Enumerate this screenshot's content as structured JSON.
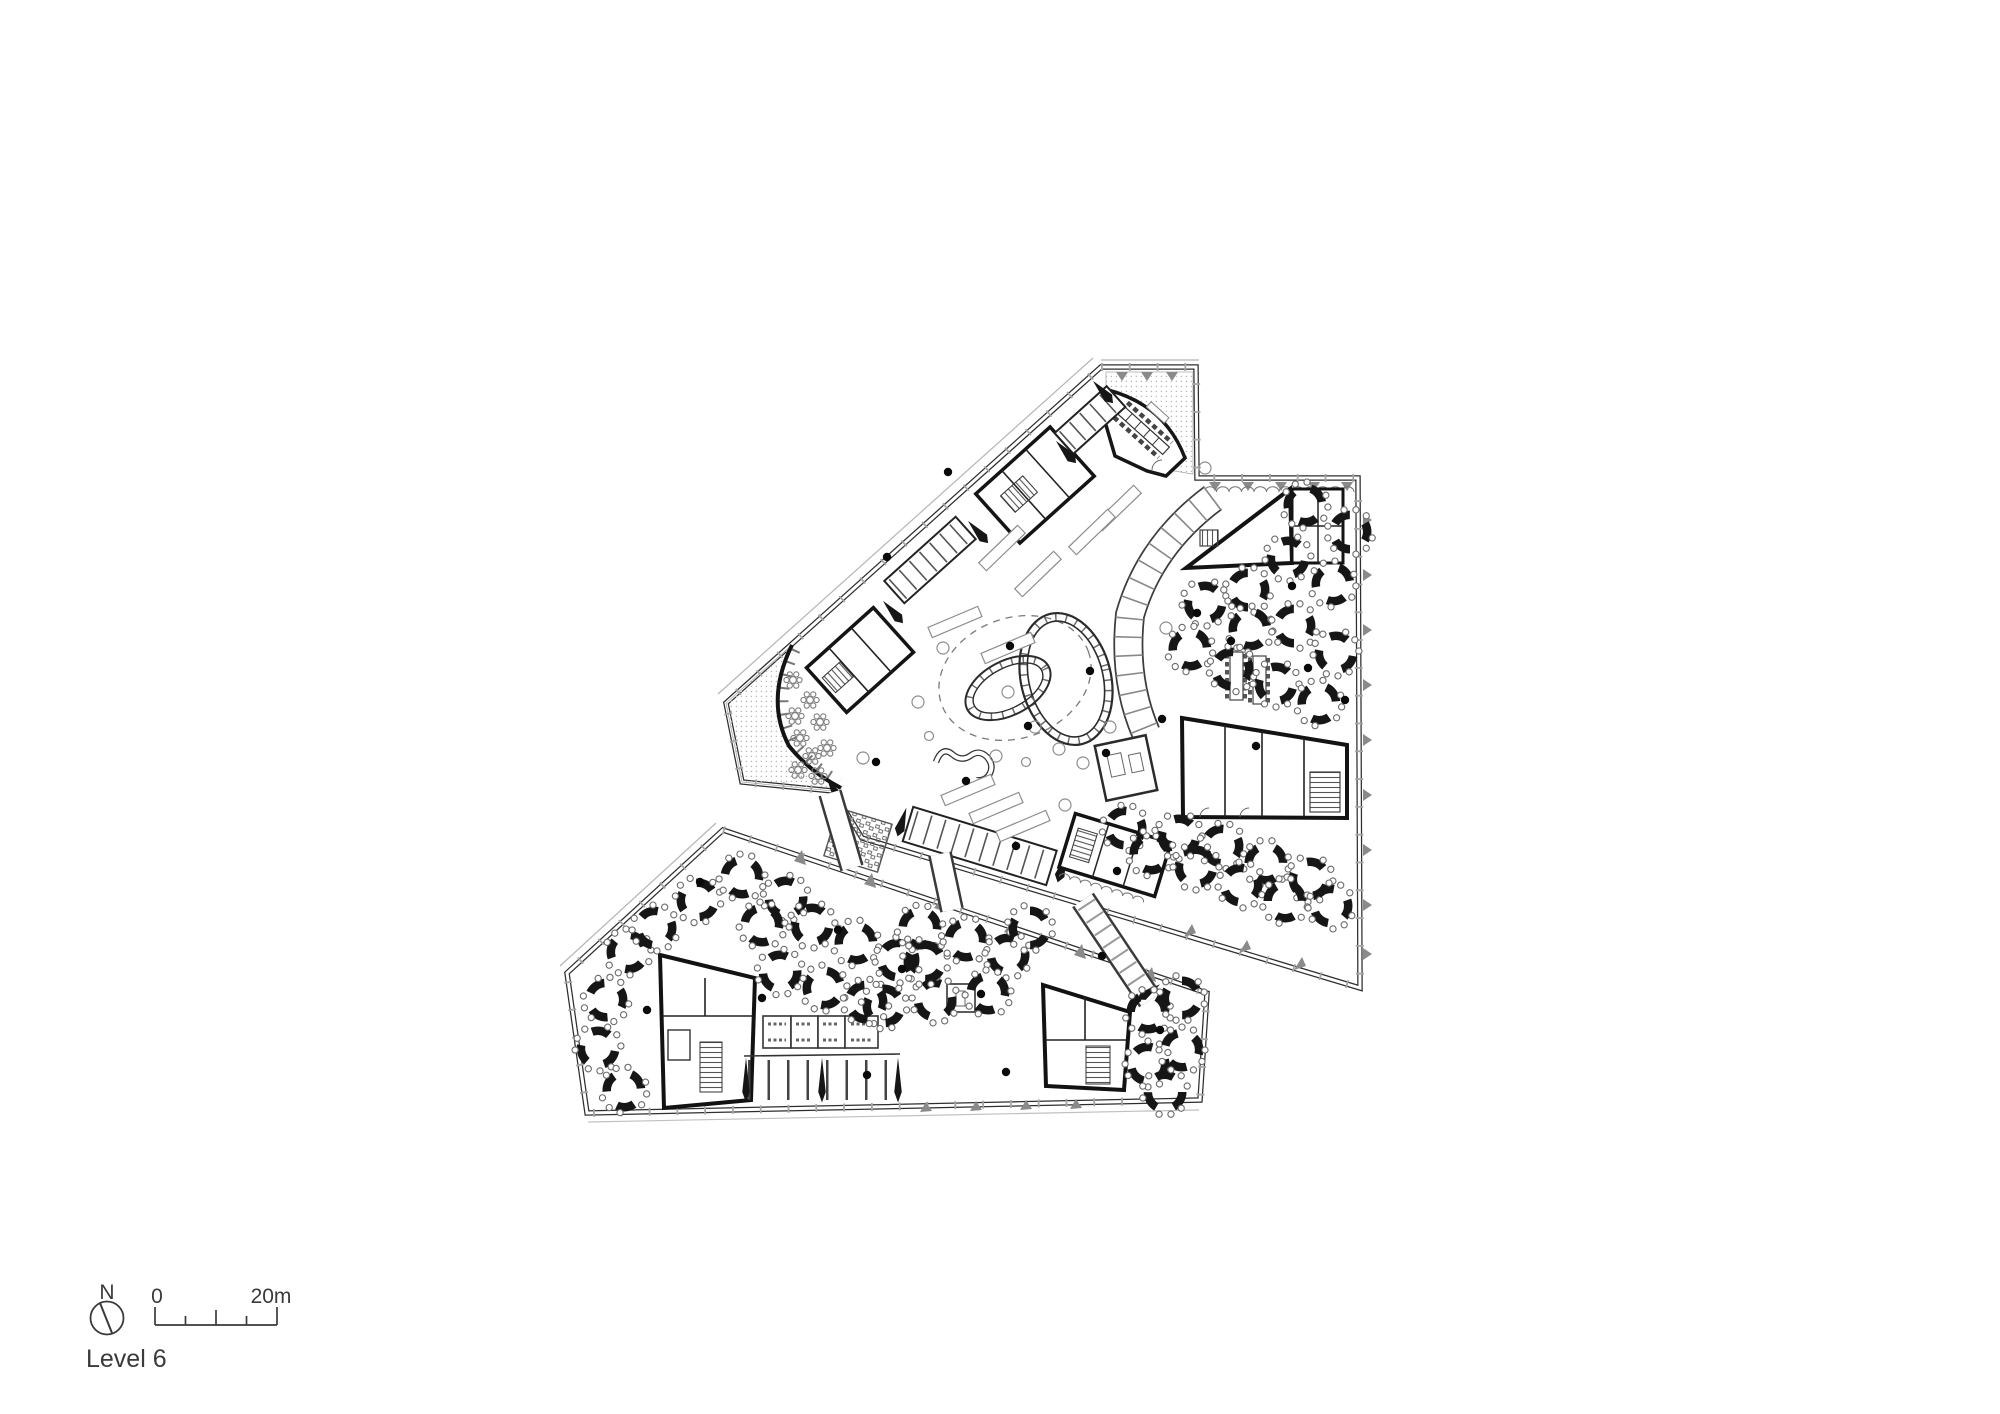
{
  "page": {
    "background_color": "#ffffff"
  },
  "drawing": {
    "level_label": "Level 6",
    "compass": {
      "label": "N"
    },
    "scale_bar": {
      "start_label": "0",
      "end_label": "20m",
      "total_meters": 20,
      "divisions": 4
    },
    "colors": {
      "ink": "#1b1b1b",
      "wall_dark": "#141414",
      "line_mid": "#555555",
      "line_light": "#999999",
      "hatch_dot": "#b7b7b7",
      "text": "#3a3a3a"
    },
    "features": [
      "boardroom",
      "roof-terrace",
      "atrium-spiral-ramp",
      "focus-booth-arc",
      "workstation-clusters",
      "stair-cores",
      "meeting-rooms",
      "locker-area",
      "link-bridges",
      "cafe-star-tables"
    ]
  }
}
